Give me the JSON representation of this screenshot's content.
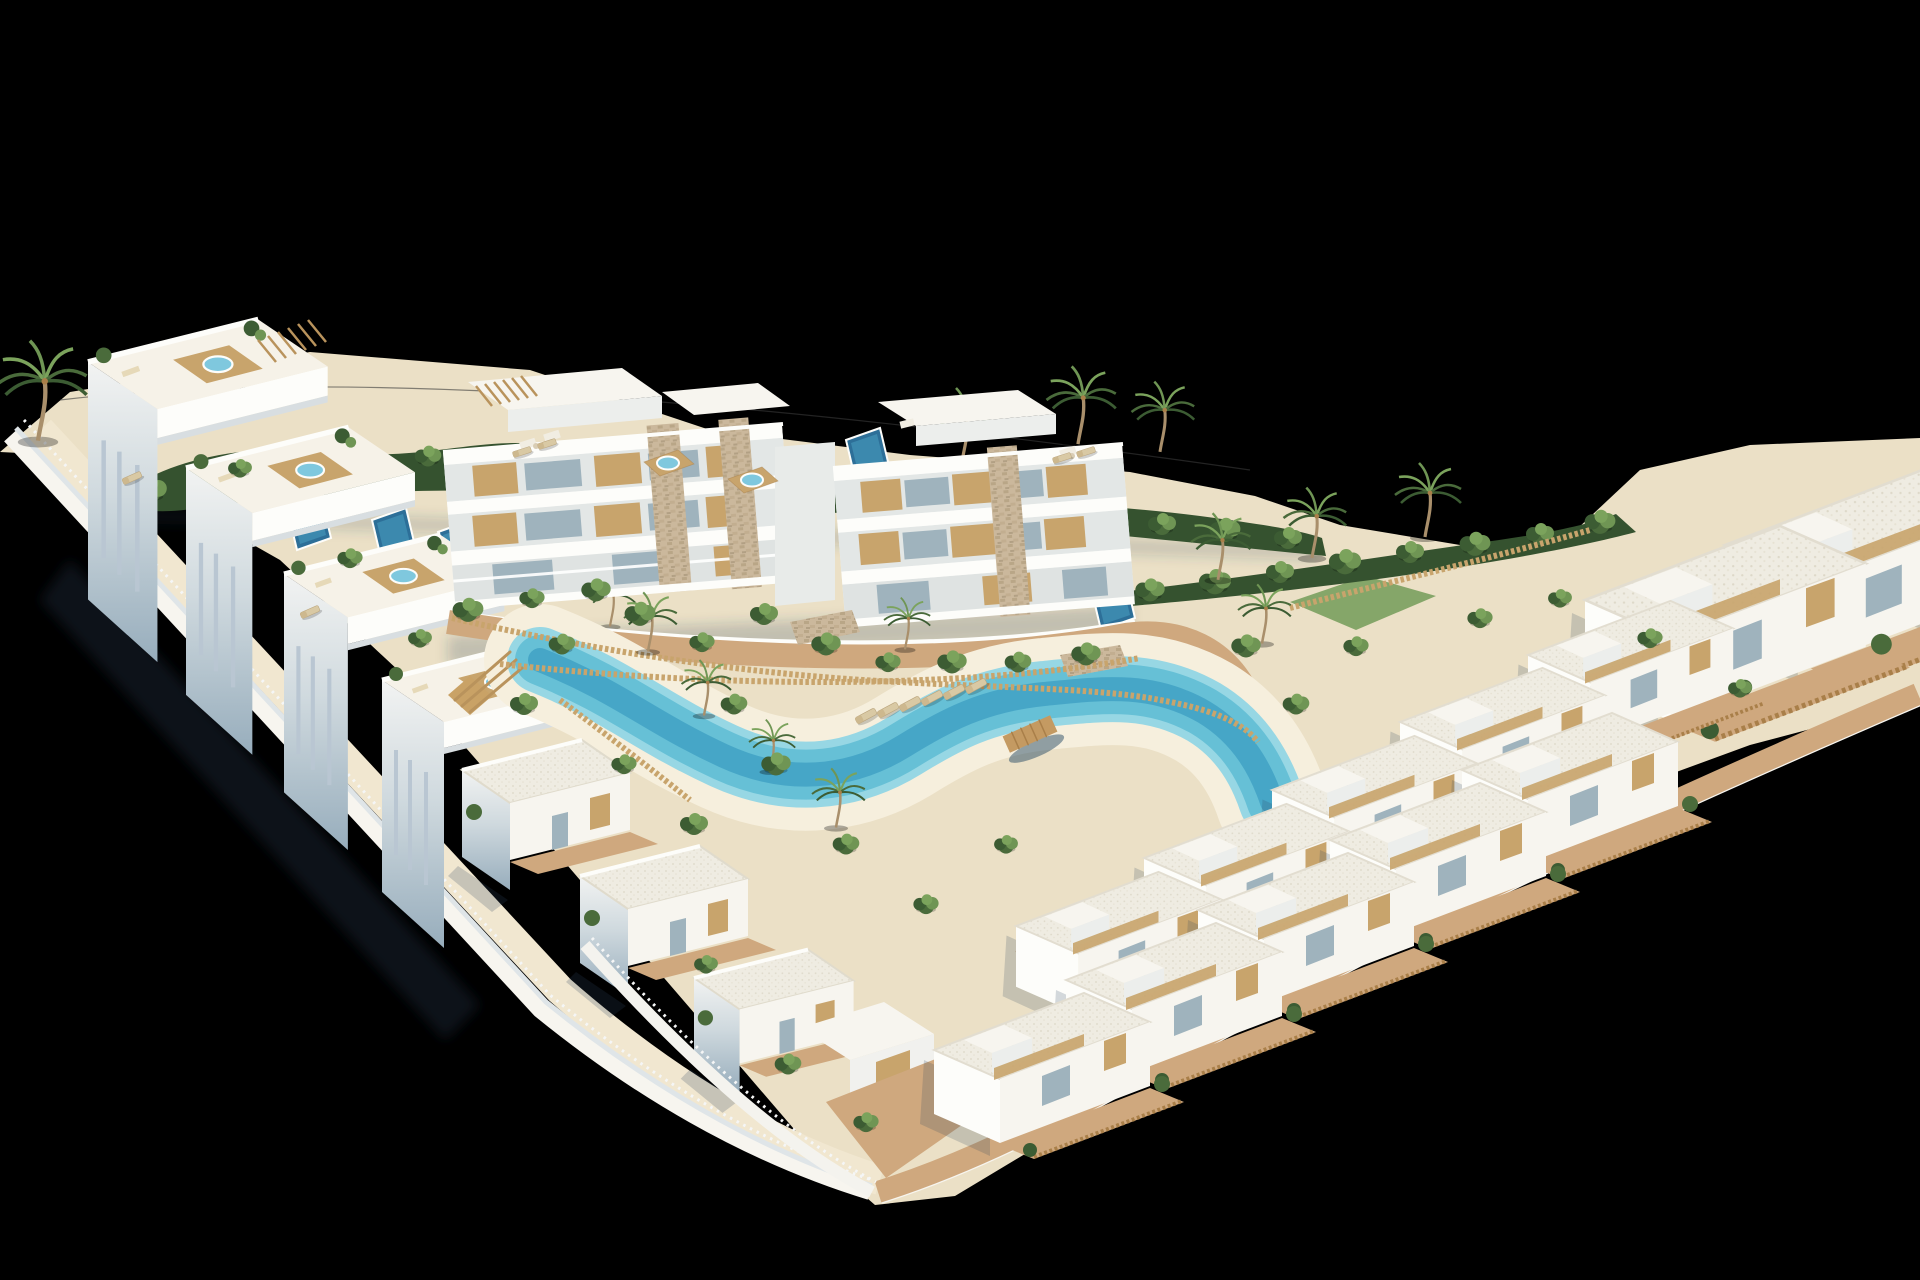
{
  "meta": {
    "title": "Aerial 3D render of a coastal residential resort development",
    "description": "Isometric-style aerial render on a black background: a V-shaped plot of white Mediterranean apartments and villas with wood accents, rooftop jacuzzi terraces, private plunge pools, a winding turquoise lagoon pool with sandy beach, sun loungers, wooden fences, hedges and palm trees."
  },
  "palette": {
    "bg": "#000000",
    "sand": "#ebe0c6",
    "sandPath": "#f1e7d0",
    "beach": "#f6efdd",
    "lagoonRim": "#97d7e4",
    "lagoon": "#66c0d6",
    "lagoonDeep": "#3c9ec2",
    "poolDeep": "#2d6f98",
    "poolMid": "#4090b4",
    "jacuzzi": "#7fc8de",
    "whiteSun": "#f7f5ef",
    "whiteBright": "#fdfdfa",
    "whiteDim": "#eceeec",
    "shadeLight": "#dde4e8",
    "shadeDeep": "#9bb1c0",
    "glass": "#9fb3bd",
    "wood": "#c8a46c",
    "woodDark": "#a97f49",
    "pergola": "#b9935c",
    "stone": "#cbb89c",
    "terracotta": "#cfa87e",
    "hedge": "#35522f",
    "leafDark": "#3c5c33",
    "leaf": "#4a6b3b",
    "leafLight": "#6f9554",
    "lawn": "#7aa05e",
    "palmGreen": "#7ba35c",
    "trunk": "#a98f6b",
    "fenceWhite": "#f5f6f6",
    "loungerTan": "#d9c9a4",
    "groundShadow": "rgba(45,70,95,0.26)"
  },
  "scene_summary": {
    "apartment_blocks": 2,
    "townhouses_left_row": 4,
    "villas_left_cluster": 3,
    "villas_right_rows": 13,
    "private_plunge_pools": 5,
    "rooftop_jacuzzis": 6,
    "lagoon_pools": 1,
    "beach_sun_loungers": 6
  },
  "sprites": {
    "hedgeBushes": [
      {
        "x": 150,
        "y": 492,
        "k": 1.2
      },
      {
        "x": 205,
        "y": 478,
        "k": 1.0
      },
      {
        "x": 258,
        "y": 470,
        "k": 1.15
      },
      {
        "x": 315,
        "y": 462,
        "k": 0.95
      },
      {
        "x": 370,
        "y": 468,
        "k": 1.1
      },
      {
        "x": 428,
        "y": 458,
        "k": 0.95
      },
      {
        "x": 486,
        "y": 462,
        "k": 1.1
      },
      {
        "x": 545,
        "y": 456,
        "k": 1.0
      },
      {
        "x": 605,
        "y": 466,
        "k": 1.15
      },
      {
        "x": 665,
        "y": 474,
        "k": 1.0
      },
      {
        "x": 725,
        "y": 480,
        "k": 1.1
      },
      {
        "x": 788,
        "y": 486,
        "k": 0.95
      },
      {
        "x": 850,
        "y": 492,
        "k": 1.15
      },
      {
        "x": 912,
        "y": 498,
        "k": 1.0
      },
      {
        "x": 975,
        "y": 506,
        "k": 1.1
      },
      {
        "x": 1038,
        "y": 512,
        "k": 1.0
      },
      {
        "x": 1100,
        "y": 518,
        "k": 1.15
      },
      {
        "x": 1162,
        "y": 526,
        "k": 1.0
      },
      {
        "x": 1225,
        "y": 532,
        "k": 1.1
      },
      {
        "x": 1288,
        "y": 540,
        "k": 1.0
      },
      {
        "x": 1150,
        "y": 592,
        "k": 1.05
      },
      {
        "x": 1215,
        "y": 584,
        "k": 1.15
      },
      {
        "x": 1280,
        "y": 574,
        "k": 1.0
      },
      {
        "x": 1345,
        "y": 564,
        "k": 1.15
      },
      {
        "x": 1410,
        "y": 554,
        "k": 1.0
      },
      {
        "x": 1475,
        "y": 546,
        "k": 1.1
      },
      {
        "x": 1540,
        "y": 536,
        "k": 1.0
      },
      {
        "x": 1600,
        "y": 524,
        "k": 1.1
      }
    ],
    "palmsBack": [
      {
        "x": 38,
        "y": 438,
        "k": 1.35
      },
      {
        "x": 962,
        "y": 460,
        "k": 1.0
      },
      {
        "x": 1078,
        "y": 442,
        "k": 1.05
      },
      {
        "x": 1160,
        "y": 450,
        "k": 0.95
      },
      {
        "x": 1312,
        "y": 556,
        "k": 0.95
      },
      {
        "x": 1425,
        "y": 535,
        "k": 1.0
      },
      {
        "x": 610,
        "y": 625,
        "k": 0.7
      }
    ],
    "pools": [
      {
        "x": 288,
        "y": 512
      },
      {
        "x": 372,
        "y": 520
      },
      {
        "x": 438,
        "y": 532
      },
      {
        "x": 846,
        "y": 440
      },
      {
        "x": 1092,
        "y": 592
      }
    ],
    "rowhouses": [
      {
        "x": 88,
        "y": 362,
        "k": 1.12
      },
      {
        "x": 186,
        "y": 468,
        "k": 1.07
      },
      {
        "x": 284,
        "y": 574,
        "k": 1.03
      },
      {
        "x": 382,
        "y": 680,
        "k": 1.0
      }
    ],
    "jacuzzis": [
      {
        "x": 664,
        "y": 470
      },
      {
        "x": 748,
        "y": 487
      }
    ],
    "villasLeft": [
      {
        "x": 462,
        "y": 770,
        "k": 1.0
      },
      {
        "x": 580,
        "y": 876,
        "k": 1.0
      },
      {
        "x": 694,
        "y": 978,
        "k": 0.95
      }
    ],
    "villasRight": [
      {
        "x": 1858,
        "y": 500,
        "k": 1.25
      },
      {
        "x": 1725,
        "y": 545,
        "k": 1.3
      },
      {
        "x": 1585,
        "y": 600,
        "k": 1.3
      },
      {
        "x": 1528,
        "y": 655,
        "k": 0.95
      },
      {
        "x": 1400,
        "y": 722,
        "k": 0.95
      },
      {
        "x": 1272,
        "y": 790,
        "k": 0.95
      },
      {
        "x": 1144,
        "y": 858,
        "k": 0.95
      },
      {
        "x": 1016,
        "y": 926,
        "k": 0.95
      },
      {
        "x": 1462,
        "y": 770,
        "k": 1.0
      },
      {
        "x": 1330,
        "y": 840,
        "k": 1.0
      },
      {
        "x": 1198,
        "y": 910,
        "k": 1.0
      },
      {
        "x": 1066,
        "y": 980,
        "k": 1.0
      },
      {
        "x": 934,
        "y": 1050,
        "k": 1.0
      }
    ],
    "palmsFront": [
      {
        "x": 648,
        "y": 650,
        "k": 0.8
      },
      {
        "x": 704,
        "y": 714,
        "k": 0.75
      },
      {
        "x": 770,
        "y": 770,
        "k": 0.7
      },
      {
        "x": 836,
        "y": 826,
        "k": 0.8
      },
      {
        "x": 905,
        "y": 648,
        "k": 0.7
      },
      {
        "x": 1218,
        "y": 578,
        "k": 0.9
      },
      {
        "x": 1262,
        "y": 642,
        "k": 0.8
      }
    ],
    "bushes": [
      {
        "x": 468,
        "y": 612,
        "k": 1.1
      },
      {
        "x": 532,
        "y": 600,
        "k": 0.9
      },
      {
        "x": 596,
        "y": 592,
        "k": 1.05
      },
      {
        "x": 562,
        "y": 646,
        "k": 0.95
      },
      {
        "x": 640,
        "y": 616,
        "k": 1.1
      },
      {
        "x": 702,
        "y": 644,
        "k": 0.9
      },
      {
        "x": 764,
        "y": 616,
        "k": 1.0
      },
      {
        "x": 826,
        "y": 646,
        "k": 1.05
      },
      {
        "x": 888,
        "y": 664,
        "k": 0.9
      },
      {
        "x": 952,
        "y": 664,
        "k": 1.05
      },
      {
        "x": 1018,
        "y": 664,
        "k": 0.95
      },
      {
        "x": 1086,
        "y": 656,
        "k": 1.05
      },
      {
        "x": 734,
        "y": 706,
        "k": 0.95
      },
      {
        "x": 776,
        "y": 766,
        "k": 1.05
      },
      {
        "x": 846,
        "y": 846,
        "k": 0.95
      },
      {
        "x": 926,
        "y": 906,
        "k": 0.9
      },
      {
        "x": 1006,
        "y": 846,
        "k": 0.85
      },
      {
        "x": 694,
        "y": 826,
        "k": 1.0
      },
      {
        "x": 624,
        "y": 766,
        "k": 0.9
      },
      {
        "x": 524,
        "y": 706,
        "k": 1.0
      },
      {
        "x": 1246,
        "y": 648,
        "k": 1.05
      },
      {
        "x": 1296,
        "y": 706,
        "k": 0.95
      },
      {
        "x": 1356,
        "y": 648,
        "k": 0.9
      },
      {
        "x": 788,
        "y": 1066,
        "k": 0.95
      },
      {
        "x": 866,
        "y": 1124,
        "k": 0.9
      },
      {
        "x": 706,
        "y": 966,
        "k": 0.85
      },
      {
        "x": 350,
        "y": 560,
        "k": 0.9
      },
      {
        "x": 420,
        "y": 640,
        "k": 0.85
      },
      {
        "x": 240,
        "y": 470,
        "k": 0.85
      },
      {
        "x": 1480,
        "y": 620,
        "k": 0.9
      },
      {
        "x": 1560,
        "y": 600,
        "k": 0.85
      },
      {
        "x": 1650,
        "y": 640,
        "k": 0.9
      },
      {
        "x": 1740,
        "y": 690,
        "k": 0.85
      }
    ],
    "loungers": [
      {
        "x": 866,
        "y": 716,
        "r": -28
      },
      {
        "x": 888,
        "y": 710,
        "r": -28
      },
      {
        "x": 910,
        "y": 704,
        "r": -28
      },
      {
        "x": 932,
        "y": 698,
        "r": -28
      },
      {
        "x": 954,
        "y": 692,
        "r": -28
      },
      {
        "x": 976,
        "y": 686,
        "r": -28
      },
      {
        "x": 522,
        "y": 452,
        "r": -18,
        "k": 0.85
      },
      {
        "x": 547,
        "y": 444,
        "r": -18,
        "k": 0.85
      },
      {
        "x": 1062,
        "y": 458,
        "r": -18,
        "k": 0.85
      },
      {
        "x": 1086,
        "y": 452,
        "r": -18,
        "k": 0.85
      },
      {
        "x": 132,
        "y": 478,
        "r": -24,
        "k": 0.9
      },
      {
        "x": 310,
        "y": 612,
        "r": -24,
        "k": 0.9
      }
    ]
  }
}
